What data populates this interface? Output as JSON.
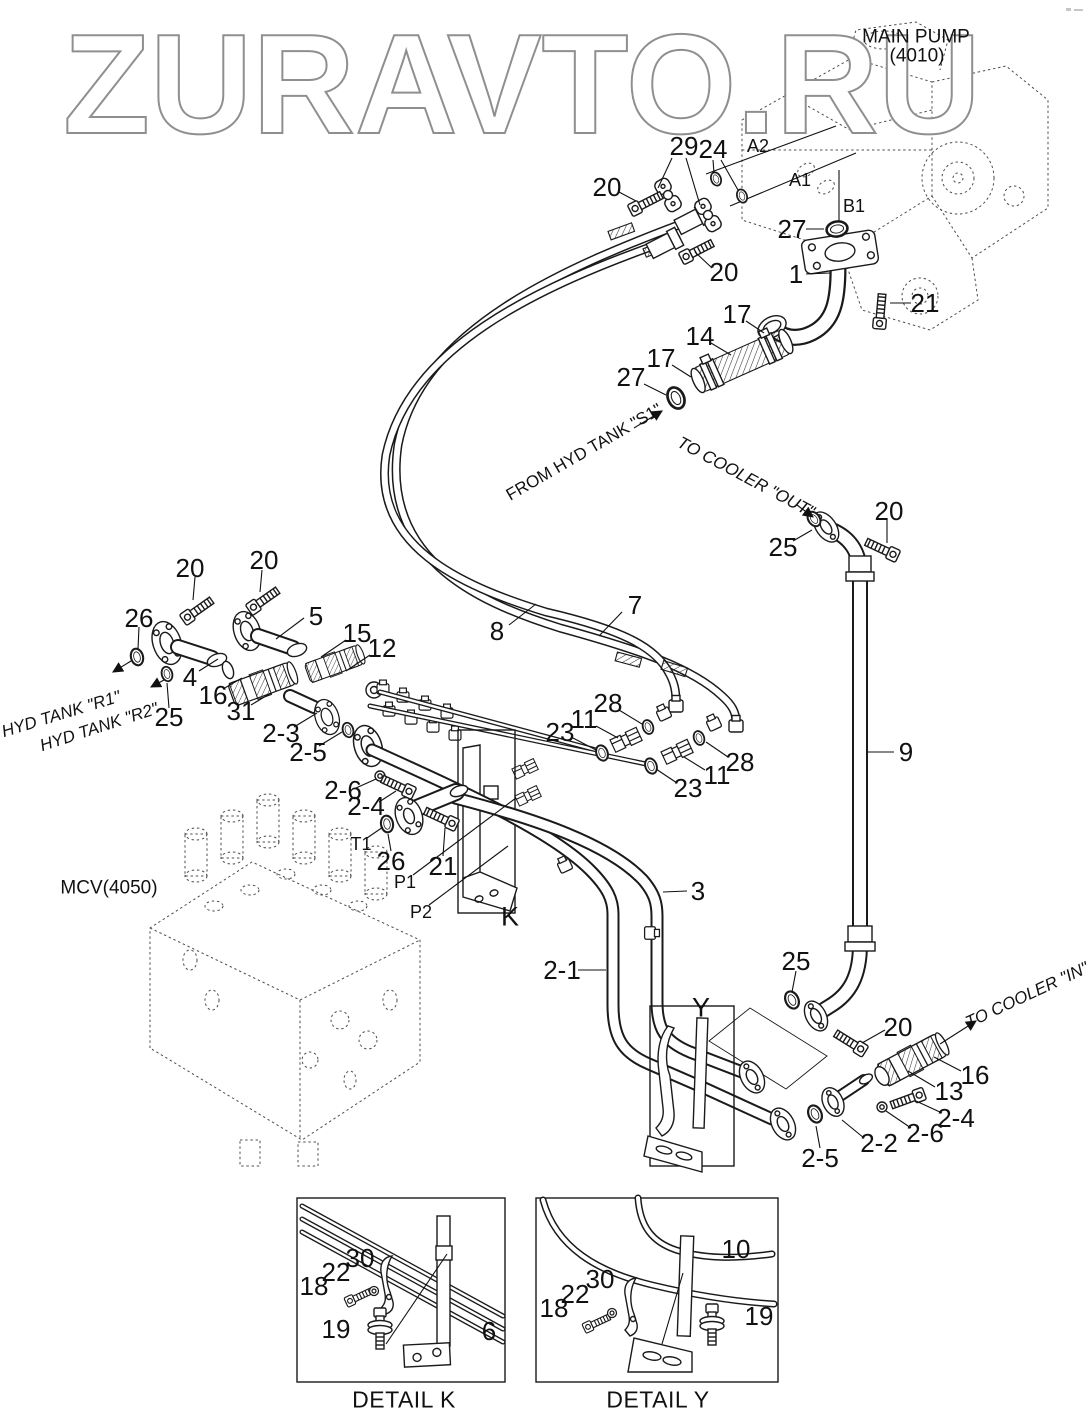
{
  "watermark": {
    "text": "ZURAVTO.RU"
  },
  "diagram": {
    "callouts": [
      {
        "t": "20",
        "x": 607,
        "y": 187,
        "c": "n"
      },
      {
        "t": "29",
        "x": 684,
        "y": 146,
        "c": "n"
      },
      {
        "t": "24",
        "x": 713,
        "y": 149,
        "c": "n"
      },
      {
        "t": "A2",
        "x": 758,
        "y": 146,
        "c": "p",
        "n": "port-label-a2"
      },
      {
        "t": "A1",
        "x": 800,
        "y": 180,
        "c": "p",
        "n": "port-label-a1"
      },
      {
        "t": "B1",
        "x": 854,
        "y": 206,
        "c": "p",
        "n": "port-label-b1"
      },
      {
        "t": "27",
        "x": 792,
        "y": 229,
        "c": "n"
      },
      {
        "t": "20",
        "x": 724,
        "y": 272,
        "c": "n"
      },
      {
        "t": "1",
        "x": 796,
        "y": 274,
        "c": "n"
      },
      {
        "t": "21",
        "x": 925,
        "y": 303,
        "c": "n"
      },
      {
        "t": "17",
        "x": 737,
        "y": 314,
        "c": "n"
      },
      {
        "t": "14",
        "x": 700,
        "y": 336,
        "c": "n"
      },
      {
        "t": "17",
        "x": 661,
        "y": 358,
        "c": "n"
      },
      {
        "t": "27",
        "x": 631,
        "y": 377,
        "c": "n"
      },
      {
        "t": "MAIN PUMP",
        "x": 916,
        "y": 37,
        "c": "m",
        "n": "main-pump-label"
      },
      {
        "t": "(4010)",
        "x": 917,
        "y": 56,
        "c": "m",
        "n": "main-pump-code"
      },
      {
        "t": "FROM HYD TANK \"S1\"",
        "x": 584,
        "y": 452,
        "c": "r",
        "r": -30,
        "n": "flow-from-hyd-tank-s1"
      },
      {
        "t": "TO COOLER \"OUT\"",
        "x": 746,
        "y": 477,
        "c": "r",
        "r": 28,
        "i": true,
        "n": "flow-to-cooler-out"
      },
      {
        "t": "25",
        "x": 783,
        "y": 547,
        "c": "n"
      },
      {
        "t": "20",
        "x": 889,
        "y": 511,
        "c": "n"
      },
      {
        "t": "20",
        "x": 190,
        "y": 568,
        "c": "n"
      },
      {
        "t": "20",
        "x": 264,
        "y": 560,
        "c": "n"
      },
      {
        "t": "26",
        "x": 139,
        "y": 618,
        "c": "n"
      },
      {
        "t": "5",
        "x": 316,
        "y": 616,
        "c": "n"
      },
      {
        "t": "15",
        "x": 357,
        "y": 633,
        "c": "n"
      },
      {
        "t": "12",
        "x": 382,
        "y": 648,
        "c": "n"
      },
      {
        "t": "4",
        "x": 190,
        "y": 677,
        "c": "n"
      },
      {
        "t": "16",
        "x": 213,
        "y": 695,
        "c": "n"
      },
      {
        "t": "31",
        "x": 241,
        "y": 711,
        "c": "n"
      },
      {
        "t": "2-3",
        "x": 281,
        "y": 733,
        "c": "n"
      },
      {
        "t": "2-5",
        "x": 308,
        "y": 752,
        "c": "n"
      },
      {
        "t": "25",
        "x": 169,
        "y": 717,
        "c": "n"
      },
      {
        "t": "HYD TANK \"R1\"",
        "x": 61,
        "y": 714,
        "c": "r",
        "r": -17,
        "i": true,
        "n": "flow-hyd-tank-r1"
      },
      {
        "t": "HYD TANK \"R2\"",
        "x": 99,
        "y": 727,
        "c": "r",
        "r": -18,
        "i": true,
        "n": "flow-hyd-tank-r2"
      },
      {
        "t": "7",
        "x": 635,
        "y": 605,
        "c": "n"
      },
      {
        "t": "8",
        "x": 497,
        "y": 631,
        "c": "n"
      },
      {
        "t": "28",
        "x": 608,
        "y": 703,
        "c": "n"
      },
      {
        "t": "11",
        "x": 584,
        "y": 719,
        "c": "n"
      },
      {
        "t": "23",
        "x": 560,
        "y": 732,
        "c": "n"
      },
      {
        "t": "23",
        "x": 688,
        "y": 788,
        "c": "n"
      },
      {
        "t": "11",
        "x": 717,
        "y": 775,
        "c": "n"
      },
      {
        "t": "28",
        "x": 740,
        "y": 762,
        "c": "n"
      },
      {
        "t": "2-6",
        "x": 343,
        "y": 790,
        "c": "n"
      },
      {
        "t": "2-4",
        "x": 366,
        "y": 806,
        "c": "n"
      },
      {
        "t": "T1",
        "x": 361,
        "y": 844,
        "c": "p",
        "n": "port-label-t1"
      },
      {
        "t": "26",
        "x": 391,
        "y": 861,
        "c": "n"
      },
      {
        "t": "21",
        "x": 443,
        "y": 866,
        "c": "n"
      },
      {
        "t": "P1",
        "x": 405,
        "y": 882,
        "c": "p",
        "n": "port-label-p1"
      },
      {
        "t": "P2",
        "x": 421,
        "y": 912,
        "c": "p",
        "n": "port-label-p2"
      },
      {
        "t": "K",
        "x": 510,
        "y": 917,
        "c": "g",
        "n": "bracket-tag-k"
      },
      {
        "t": "MCV(4050)",
        "x": 109,
        "y": 888,
        "c": "m",
        "n": "mcv-label"
      },
      {
        "t": "3",
        "x": 698,
        "y": 891,
        "c": "n"
      },
      {
        "t": "2-1",
        "x": 562,
        "y": 970,
        "c": "n"
      },
      {
        "t": "9",
        "x": 906,
        "y": 752,
        "c": "n"
      },
      {
        "t": "25",
        "x": 796,
        "y": 961,
        "c": "n"
      },
      {
        "t": "Y",
        "x": 701,
        "y": 1008,
        "c": "g",
        "n": "bracket-tag-y"
      },
      {
        "t": "20",
        "x": 898,
        "y": 1027,
        "c": "n"
      },
      {
        "t": "TO COOLER \"IN\"",
        "x": 1027,
        "y": 995,
        "c": "r",
        "r": -25,
        "i": true,
        "n": "flow-to-cooler-in"
      },
      {
        "t": "16",
        "x": 975,
        "y": 1075,
        "c": "n"
      },
      {
        "t": "13",
        "x": 949,
        "y": 1091,
        "c": "n"
      },
      {
        "t": "2-4",
        "x": 956,
        "y": 1118,
        "c": "n"
      },
      {
        "t": "2-6",
        "x": 925,
        "y": 1133,
        "c": "n"
      },
      {
        "t": "2-2",
        "x": 879,
        "y": 1143,
        "c": "n"
      },
      {
        "t": "2-5",
        "x": 820,
        "y": 1158,
        "c": "n"
      },
      {
        "t": "30",
        "x": 360,
        "y": 1258,
        "c": "n"
      },
      {
        "t": "22",
        "x": 336,
        "y": 1272,
        "c": "n"
      },
      {
        "t": "18",
        "x": 314,
        "y": 1286,
        "c": "n"
      },
      {
        "t": "19",
        "x": 336,
        "y": 1329,
        "c": "n"
      },
      {
        "t": "6",
        "x": 489,
        "y": 1331,
        "c": "n"
      },
      {
        "t": "DETAIL K",
        "x": 404,
        "y": 1400,
        "c": "t",
        "n": "detail-k-title"
      },
      {
        "t": "10",
        "x": 736,
        "y": 1249,
        "c": "n"
      },
      {
        "t": "30",
        "x": 600,
        "y": 1279,
        "c": "n"
      },
      {
        "t": "22",
        "x": 575,
        "y": 1294,
        "c": "n"
      },
      {
        "t": "18",
        "x": 554,
        "y": 1308,
        "c": "n"
      },
      {
        "t": "19",
        "x": 759,
        "y": 1316,
        "c": "n"
      },
      {
        "t": "DETAIL Y",
        "x": 658,
        "y": 1400,
        "c": "t",
        "n": "detail-y-title"
      }
    ]
  }
}
